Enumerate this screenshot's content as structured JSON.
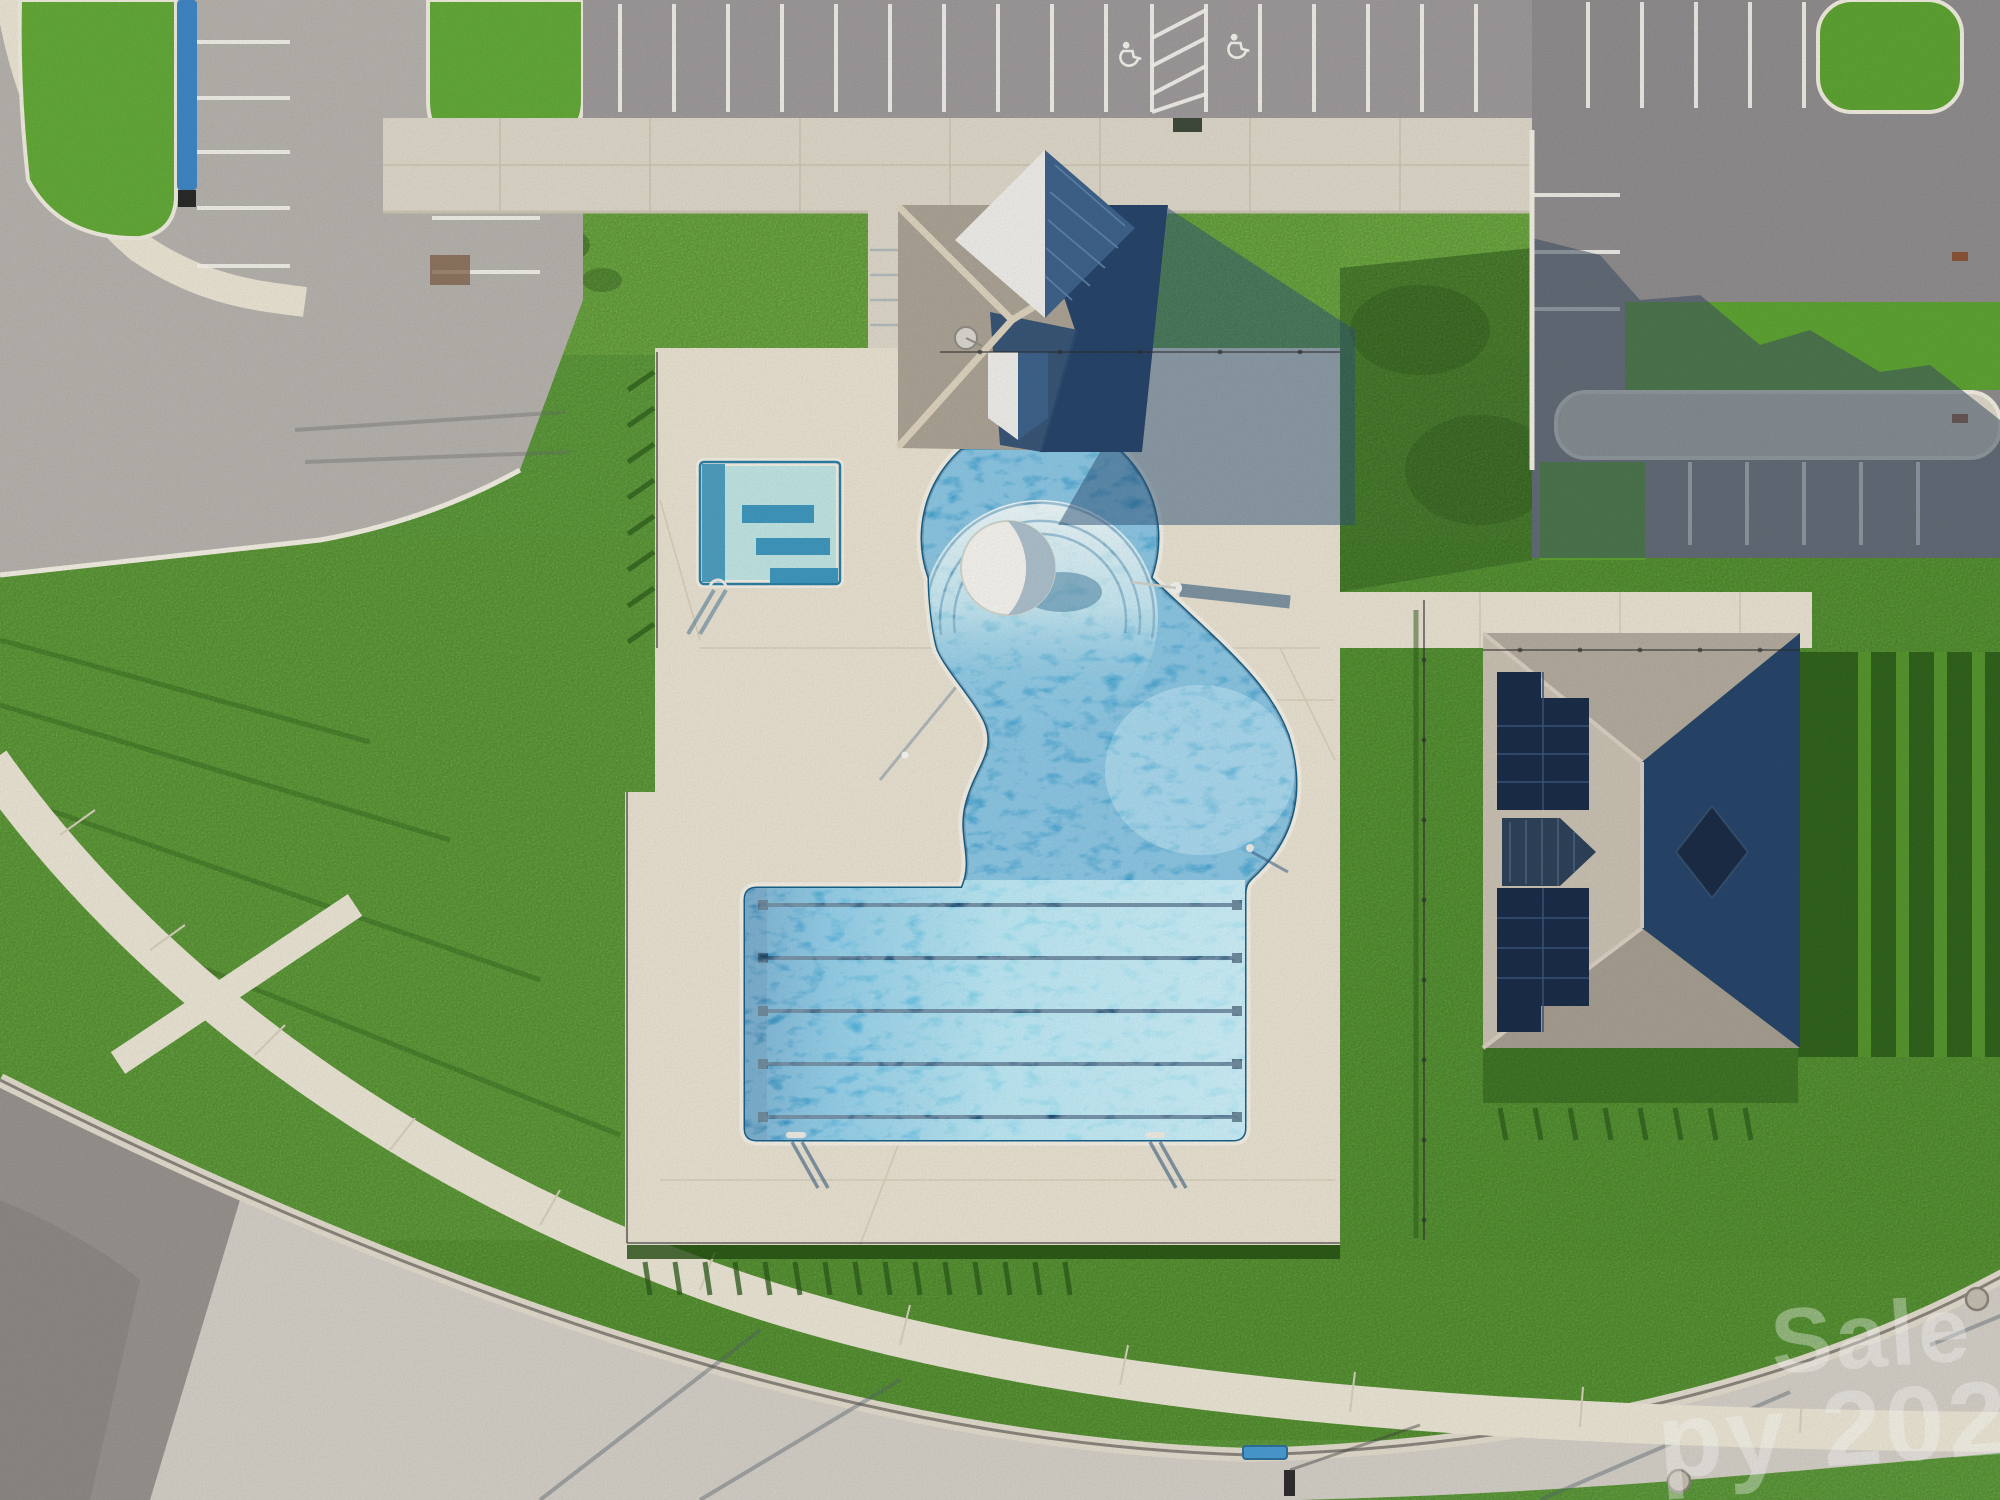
{
  "scene": {
    "type": "aerial-drone-photo",
    "subject": "Overhead view of a community amenity center: clubhouse, free-form swimming pool with lap lanes, kiddie pool, solar-roof pavilion, parking lots, lawns, perimeter fence shadows and a curved street with sidewalks"
  },
  "watermark": {
    "line1": "Sale",
    "line2": "py 2025"
  },
  "pool": {
    "lap_lane_ropes": 5,
    "step_rings": 3,
    "features": [
      "zero-entry circular section",
      "white dome fountain",
      "free-form lagoon",
      "rectangular lap section",
      "kiddie pool"
    ]
  },
  "parking": {
    "accessible_symbols": 2,
    "striped_access_aisle": 1,
    "blue_painted_curb": true
  },
  "features": [
    "clubhouse with cross-gable shingle roof and white metal gables",
    "pavilion with rooftop solar panel arrays, dormer and dark cupola",
    "black pool fence with cast shadows on lawn",
    "concrete pool deck",
    "top parking lot with accessible spaces",
    "left parking lot with landscaped islands",
    "right parking lot with concrete median walkway under building shadow",
    "curved residential street with curb and gutter",
    "sidewalk arc with grass verge",
    "two manhole covers",
    "blue bench on sidewalk",
    "street sign post",
    "satellite dish on clubhouse roof"
  ],
  "colors": {
    "grass": "#5ea436",
    "grass_light": "#6fb33c",
    "grass_dark": "#3f7a22",
    "fence_shadow": "#2c5a1a",
    "asphalt": "#9d999a",
    "asphalt_dark": "#8f8c8d",
    "concrete": "#dcd6c8",
    "deck": "#e7e0d0",
    "sidewalk": "#e9e3d3",
    "road": "#d2cec6",
    "water_deep": "#2a84b8",
    "water_mid": "#47a6d2",
    "water_shallow": "#cdeef1",
    "lane_rope": "#1d4e74",
    "roof_shingle": "#aaa294",
    "roof_shadow": "#27456a",
    "metal_white": "#edece8",
    "metal_blue": "#3e628a",
    "solar": "#1b2d49",
    "blue_curb": "#3f86c4",
    "bench_blue": "#4a9bd0",
    "watermark": "#ffffff"
  }
}
